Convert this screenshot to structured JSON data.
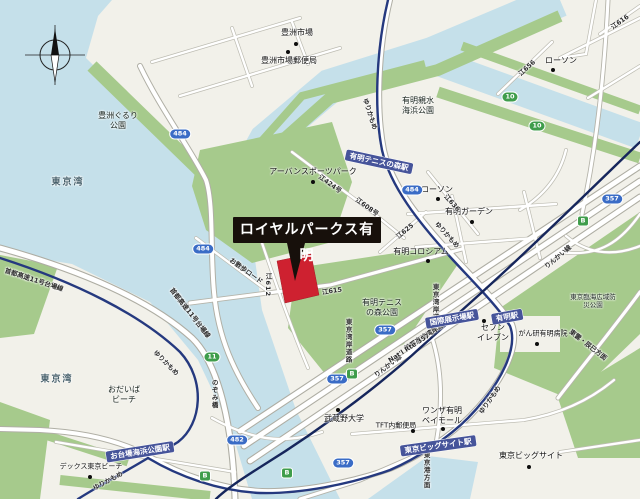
{
  "callout": {
    "label": "ロイヤルパークス有明"
  },
  "colors": {
    "water": "#c5e0ea",
    "land": "#f2f1ea",
    "park": "#a6ca8c",
    "rail_yurikamome": "#25397f",
    "rail_rinkai": "#16265c",
    "station_bg": "#46549a",
    "marker_red": "#ce2130",
    "callout_bg": "#17100b",
    "shield_blue": "#3a6cc6",
    "shield_green": "#3f9d4b"
  },
  "water_labels": [
    {
      "name": "tokyo-bay-north",
      "text": "東京湾",
      "x": 68,
      "y": 183
    },
    {
      "name": "tokyo-bay-south",
      "text": "東京湾",
      "x": 57,
      "y": 380
    }
  ],
  "park_labels": [
    {
      "name": "toyosu-gururi-park",
      "text": "豊洲ぐるり\n公園",
      "x": 118,
      "y": 121
    },
    {
      "name": "ariake-shinsui-kaihin-park",
      "text": "有明親水\n海浜公園",
      "x": 418,
      "y": 106
    },
    {
      "name": "ariake-tennis-no-mori-park",
      "text": "有明テニス\nの森公園",
      "x": 382,
      "y": 308
    },
    {
      "name": "tokyo-rinkai-disaster-prevention-park",
      "text": "東京臨海広域防災公園",
      "x": 593,
      "y": 301,
      "size": 6.5
    },
    {
      "name": "odaiba-beach",
      "text": "おだいば\nビーチ",
      "x": 124,
      "y": 395
    }
  ],
  "pois": [
    {
      "name": "toyosu-market",
      "text": "豊洲市場",
      "x": 297,
      "y": 33,
      "dot": [
        296,
        44
      ]
    },
    {
      "name": "toyosu-market-post-office",
      "text": "豊洲市場郵便局",
      "x": 289,
      "y": 61,
      "dot": [
        288,
        52
      ]
    },
    {
      "name": "urban-sports-park",
      "text": "アーバンスポーツパーク",
      "x": 313,
      "y": 172,
      "dot": [
        313,
        182
      ]
    },
    {
      "name": "ariake-coliseum",
      "text": "有明コロシアム",
      "x": 421,
      "y": 252,
      "dot": [
        428,
        261
      ]
    },
    {
      "name": "lawson-shinonome",
      "text": "ローソン",
      "x": 561,
      "y": 61,
      "dot": [
        553,
        70
      ]
    },
    {
      "name": "lawson-ariake",
      "text": "ローソン",
      "x": 437,
      "y": 190,
      "dot": [
        438,
        199
      ]
    },
    {
      "name": "ariake-garden",
      "text": "有明ガーデン",
      "x": 469,
      "y": 212,
      "dot": [
        472,
        222
      ]
    },
    {
      "name": "seven-eleven",
      "text": "セブン\nイレブン",
      "x": 493,
      "y": 333,
      "dot": [
        484,
        321
      ]
    },
    {
      "name": "cancer-institute-hospital",
      "text": "がん研有明病院",
      "x": 543,
      "y": 334,
      "size": 7,
      "dot": [
        537,
        344
      ]
    },
    {
      "name": "musashino-university",
      "text": "武蔵野大学",
      "x": 344,
      "y": 419,
      "dot": [
        338,
        410
      ]
    },
    {
      "name": "tft-post-office",
      "text": "TFT内郵便局",
      "x": 396,
      "y": 426,
      "size": 7,
      "dot": [
        413,
        431
      ]
    },
    {
      "name": "wanza-ariake-baymall",
      "text": "ワンザ有明\nベイモール",
      "x": 442,
      "y": 416,
      "dot": [
        443,
        429
      ]
    },
    {
      "name": "tokyo-big-sight",
      "text": "東京ビッグサイト",
      "x": 531,
      "y": 456,
      "dot": [
        529,
        467
      ]
    },
    {
      "name": "decks-tokyo-beach",
      "text": "デックス東京ビーチ",
      "x": 91,
      "y": 467,
      "size": 7,
      "dot": [
        90,
        477
      ]
    }
  ],
  "stations": [
    {
      "name": "ariake-tennis-no-mori-station",
      "text": "有明テニスの森駅",
      "x": 379,
      "y": 162,
      "rot": 12
    },
    {
      "name": "kokusai-tenjijo-station",
      "text": "国際展示場駅",
      "x": 452,
      "y": 319,
      "rot": -10
    },
    {
      "name": "ariake-station",
      "text": "有明駅",
      "x": 507,
      "y": 317,
      "rot": -10
    },
    {
      "name": "tokyo-big-sight-station",
      "text": "東京ビッグサイト駅",
      "x": 438,
      "y": 446,
      "rot": -8
    },
    {
      "name": "odaiba-kaihin-koen-station",
      "text": "お台場海浜公園駅",
      "x": 140,
      "y": 452,
      "rot": -9
    }
  ],
  "road_labels": [
    {
      "name": "rail-label-yurikamome",
      "text": "ゆりかもめ",
      "x": 370,
      "y": 114,
      "rot": 72
    },
    {
      "name": "rail-label-yurikamome",
      "text": "ゆりかもめ",
      "x": 447,
      "y": 235,
      "rot": 48
    },
    {
      "name": "rail-label-yurikamome",
      "text": "ゆりかもめ",
      "x": 490,
      "y": 400,
      "rot": -55
    },
    {
      "name": "rail-label-yurikamome",
      "text": "ゆりかもめ",
      "x": 166,
      "y": 363,
      "rot": 45
    },
    {
      "name": "rail-label-yurikamome",
      "text": "ゆりかもめ",
      "x": 108,
      "y": 481,
      "rot": -28
    },
    {
      "name": "rail-label-rinkai",
      "text": "りんかい線",
      "x": 558,
      "y": 257,
      "rot": -40
    },
    {
      "name": "rail-label-rinkai",
      "text": "りんかい線",
      "x": 388,
      "y": 366,
      "rot": -38
    },
    {
      "name": "expressway-label-daiba-line",
      "text": "首都高速11号台場線",
      "x": 34,
      "y": 280,
      "rot": 18
    },
    {
      "name": "expressway-label-daiba-line",
      "text": "首都高速11号台場線",
      "x": 190,
      "y": 313,
      "rot": 52
    },
    {
      "name": "expressway-label-wangan-line",
      "text": "首都高速湾岸線",
      "x": 424,
      "y": 337,
      "rot": -33
    },
    {
      "name": "route-357-label",
      "text": "Nat'l Rte 357",
      "x": 409,
      "y": 348,
      "rot": -33
    },
    {
      "name": "wangan-road-label",
      "text": "東京湾岸道路",
      "x": 435,
      "y": 306,
      "vert": true
    },
    {
      "name": "wangan-road-label",
      "text": "東京湾岸道路",
      "x": 348,
      "y": 341,
      "vert": true
    },
    {
      "name": "shinonome-tatsumi-label",
      "text": "東雲・辰巳方面",
      "x": 588,
      "y": 345,
      "rot": 38
    },
    {
      "name": "nozomi-bridge-label",
      "text": "のぞみ橋",
      "x": 214,
      "y": 394,
      "vert": true
    },
    {
      "name": "tokyo-port-label",
      "text": "東京港方面",
      "x": 426,
      "y": 470,
      "vert": true
    },
    {
      "name": "road-label-e424",
      "text": "江424号",
      "x": 330,
      "y": 184,
      "rot": 36
    },
    {
      "name": "road-label-e608",
      "text": "江608号",
      "x": 367,
      "y": 207,
      "rot": 36
    },
    {
      "name": "road-label-e615",
      "text": "江615",
      "x": 332,
      "y": 291,
      "rot": -8
    },
    {
      "name": "road-label-e612",
      "text": "江612",
      "x": 268,
      "y": 285,
      "vert": true
    },
    {
      "name": "road-label-e625",
      "text": "江625",
      "x": 405,
      "y": 231,
      "rot": -40
    },
    {
      "name": "road-label-e636",
      "text": "江636",
      "x": 452,
      "y": 203,
      "rot": 48
    },
    {
      "name": "road-label-e656",
      "text": "江656",
      "x": 527,
      "y": 68,
      "rot": -42
    },
    {
      "name": "road-label-e616",
      "text": "江616",
      "x": 620,
      "y": 22,
      "rot": -35
    },
    {
      "name": "road-label-osanpo",
      "text": "お散歩ロード",
      "x": 246,
      "y": 271,
      "rot": 36
    }
  ],
  "shields": [
    {
      "name": "route-shield-484",
      "text": "484",
      "x": 180,
      "y": 134,
      "style": "blue"
    },
    {
      "name": "route-shield-484",
      "text": "484",
      "x": 203,
      "y": 249,
      "style": "blue"
    },
    {
      "name": "route-shield-484",
      "text": "484",
      "x": 412,
      "y": 190,
      "style": "blue"
    },
    {
      "name": "route-shield-357",
      "text": "357",
      "x": 612,
      "y": 199,
      "style": "blue"
    },
    {
      "name": "route-shield-357",
      "text": "357",
      "x": 385,
      "y": 330,
      "style": "blue"
    },
    {
      "name": "route-shield-357",
      "text": "357",
      "x": 337,
      "y": 379,
      "style": "blue"
    },
    {
      "name": "route-shield-357",
      "text": "357",
      "x": 343,
      "y": 463,
      "style": "blue"
    },
    {
      "name": "route-shield-482",
      "text": "482",
      "x": 237,
      "y": 440,
      "style": "blue"
    },
    {
      "name": "route-shield-10",
      "text": "10",
      "x": 510,
      "y": 97,
      "style": "green"
    },
    {
      "name": "route-shield-10",
      "text": "10",
      "x": 537,
      "y": 126,
      "style": "green"
    },
    {
      "name": "route-shield-11",
      "text": "11",
      "x": 212,
      "y": 357,
      "style": "green"
    },
    {
      "name": "route-shield-B",
      "text": "B",
      "x": 583,
      "y": 221,
      "style": "green",
      "shape": "sq"
    },
    {
      "name": "route-shield-B",
      "text": "B",
      "x": 352,
      "y": 374,
      "style": "green",
      "shape": "sq"
    },
    {
      "name": "route-shield-B",
      "text": "B",
      "x": 287,
      "y": 473,
      "style": "green",
      "shape": "sq"
    },
    {
      "name": "route-shield-B",
      "text": "B",
      "x": 205,
      "y": 476,
      "style": "green",
      "shape": "sq"
    }
  ]
}
